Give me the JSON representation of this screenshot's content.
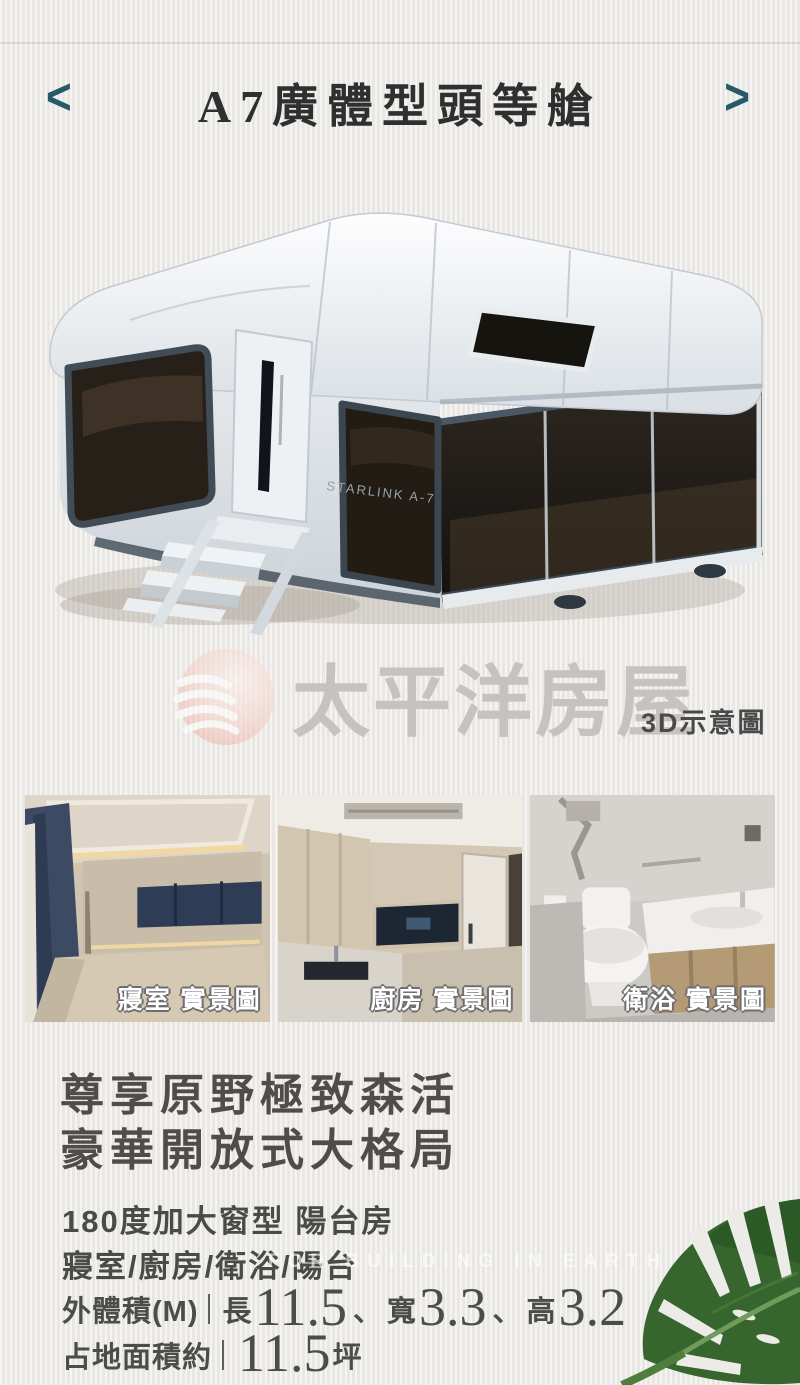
{
  "colors": {
    "accent_teal": "#28596a",
    "background": "#edebe8",
    "leaf_green": "#36652e",
    "brand_watermark_gray": "#c6c2bf"
  },
  "header": {
    "title": "A7廣體型頭等艙",
    "prev_icon": "<",
    "next_icon": ">"
  },
  "hero": {
    "watermark_brand": "太平洋房屋",
    "caption": "3D示意圖",
    "side_label": "STARLINK A-7"
  },
  "photos": [
    {
      "label": "寢室 實景圖"
    },
    {
      "label": "廚房 實景圖"
    },
    {
      "label": "衛浴 實景圖"
    }
  ],
  "headline": {
    "line1": "尊享原野極致森活",
    "line2": "豪華開放式大格局"
  },
  "details": {
    "feature1": "180度加大窗型 陽台房",
    "feature2": "寢室/廚房/衛浴/陽台",
    "faint_watermark": "FOR BUILDING IN EARTH",
    "dims": {
      "label": "外體積(M)",
      "items": [
        {
          "name": "長",
          "value": "11.5"
        },
        {
          "name": "寬",
          "value": "3.3"
        },
        {
          "name": "高",
          "value": "3.2"
        }
      ],
      "separator": "、"
    },
    "area": {
      "label": "占地面積約",
      "value": "11.5",
      "unit": "坪"
    }
  }
}
